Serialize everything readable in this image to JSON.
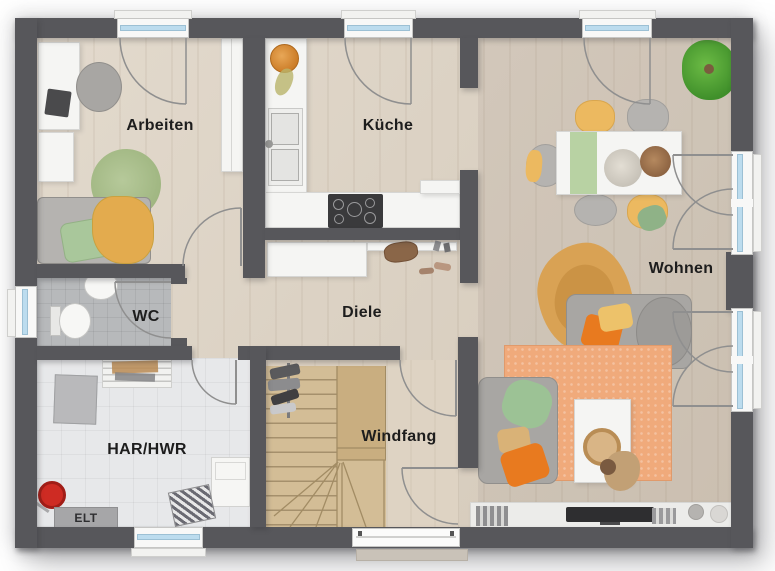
{
  "rooms": {
    "arbeiten": {
      "label": "Arbeiten"
    },
    "kueche": {
      "label": "Küche"
    },
    "wohnen": {
      "label": "Wohnen"
    },
    "wc": {
      "label": "WC"
    },
    "diele": {
      "label": "Diele"
    },
    "har_hwr": {
      "label": "HAR/HWR"
    },
    "windfang": {
      "label": "Windfang"
    },
    "elt": {
      "label": "ELT"
    }
  },
  "colors": {
    "wall": "#57575b",
    "wood_floor": "#dcd1c1",
    "windfang_floor": "#ded3c3",
    "wc_tile": "#b7b9bb",
    "har_tile": "#e7e8ea",
    "window_glass": "#bcdcee",
    "door_swing_line": "#8f8f8f",
    "stair_wood": "#d3bd96",
    "accent_orange": "#e87a1f",
    "accent_yellow": "#ecb960",
    "accent_green": "#9cc295",
    "rug_orange": "#f0aa7b",
    "rug_green": "#abbf8c"
  }
}
